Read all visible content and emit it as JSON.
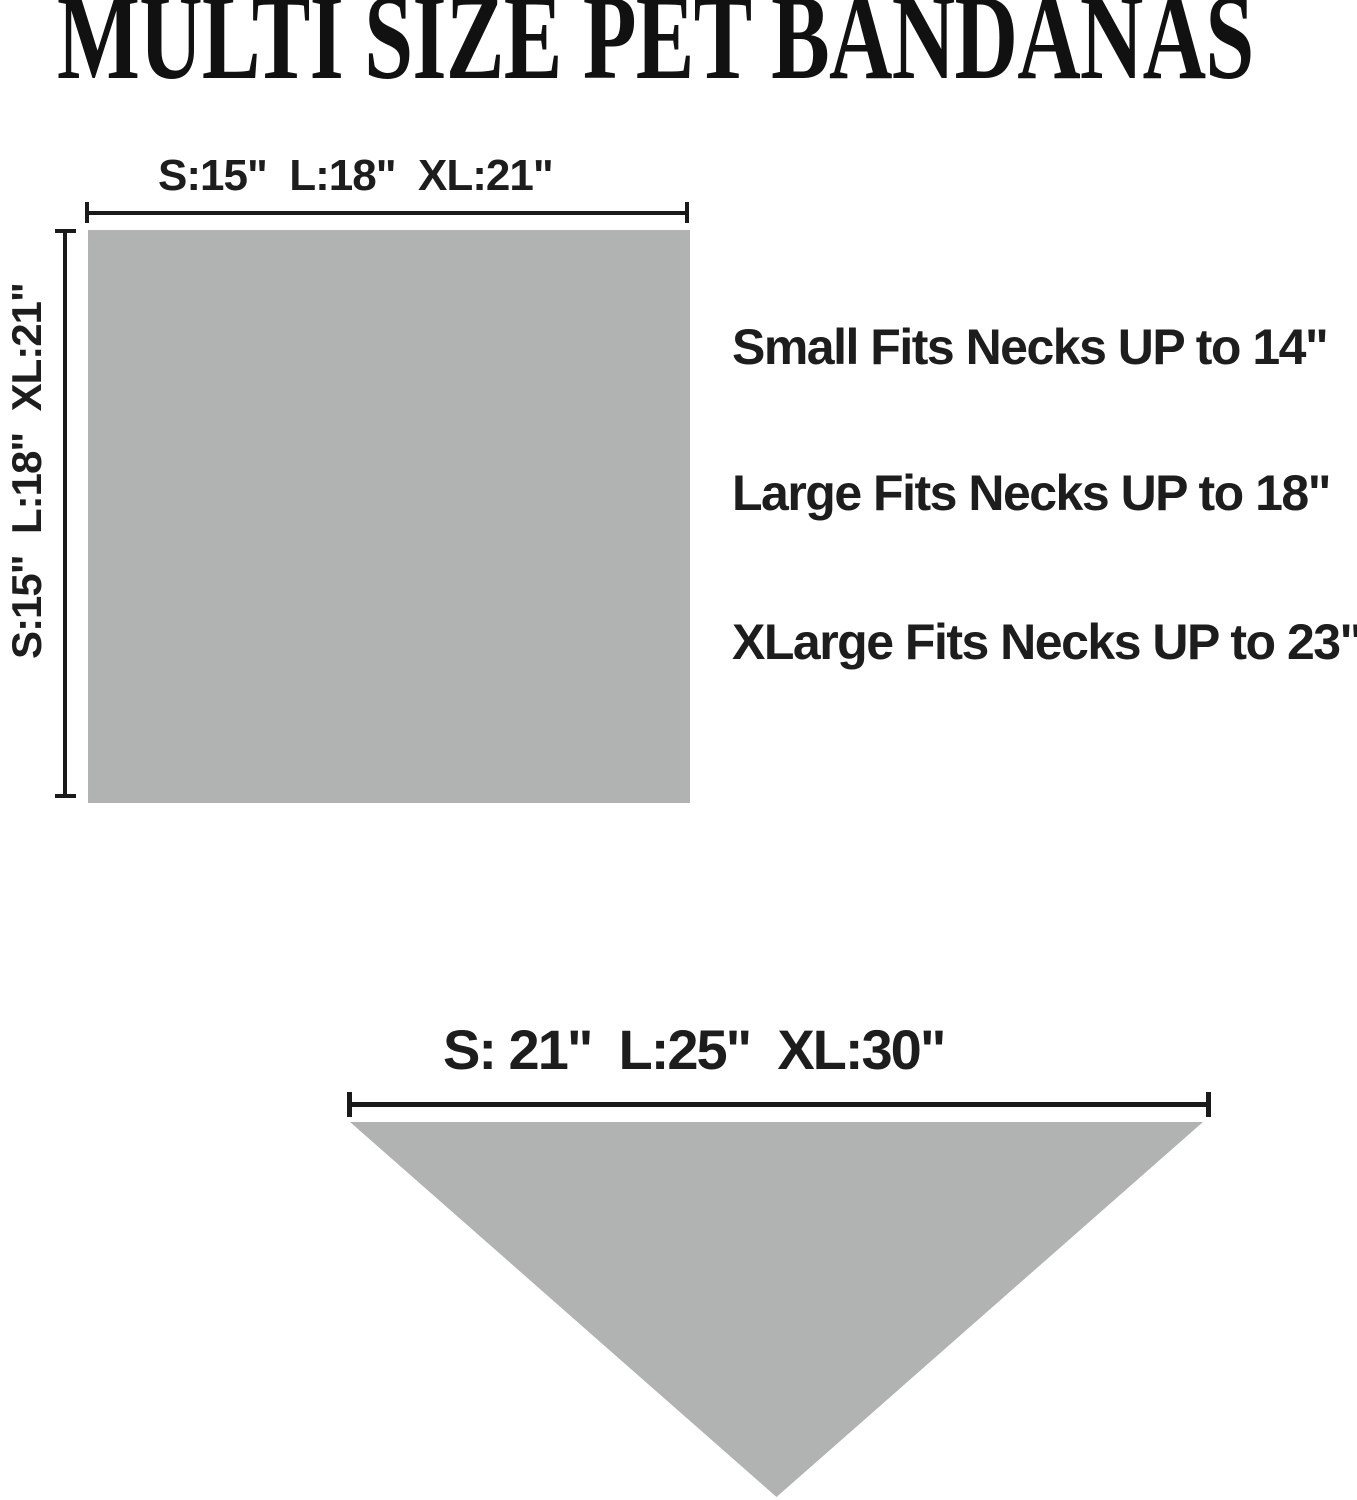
{
  "title": "MULTI SIZE PET BANDANAS",
  "square_diagram": {
    "width_label": "S:15\"  L:18\"  XL:21\"",
    "height_label": "S:15\"  L:18\"  XL:21\""
  },
  "fit_notes": {
    "small": "Small Fits Necks UP to 14\"",
    "large": "Large Fits Necks UP to 18\"",
    "xlarge": "XLarge Fits Necks UP to 23\""
  },
  "triangle_diagram": {
    "width_label": "S: 21\"  L:25\"  XL:30\""
  },
  "colors": {
    "fabric_gray": "#b0b3b2",
    "line_black": "#1a1a1a",
    "text_black": "#1d1d1d"
  }
}
